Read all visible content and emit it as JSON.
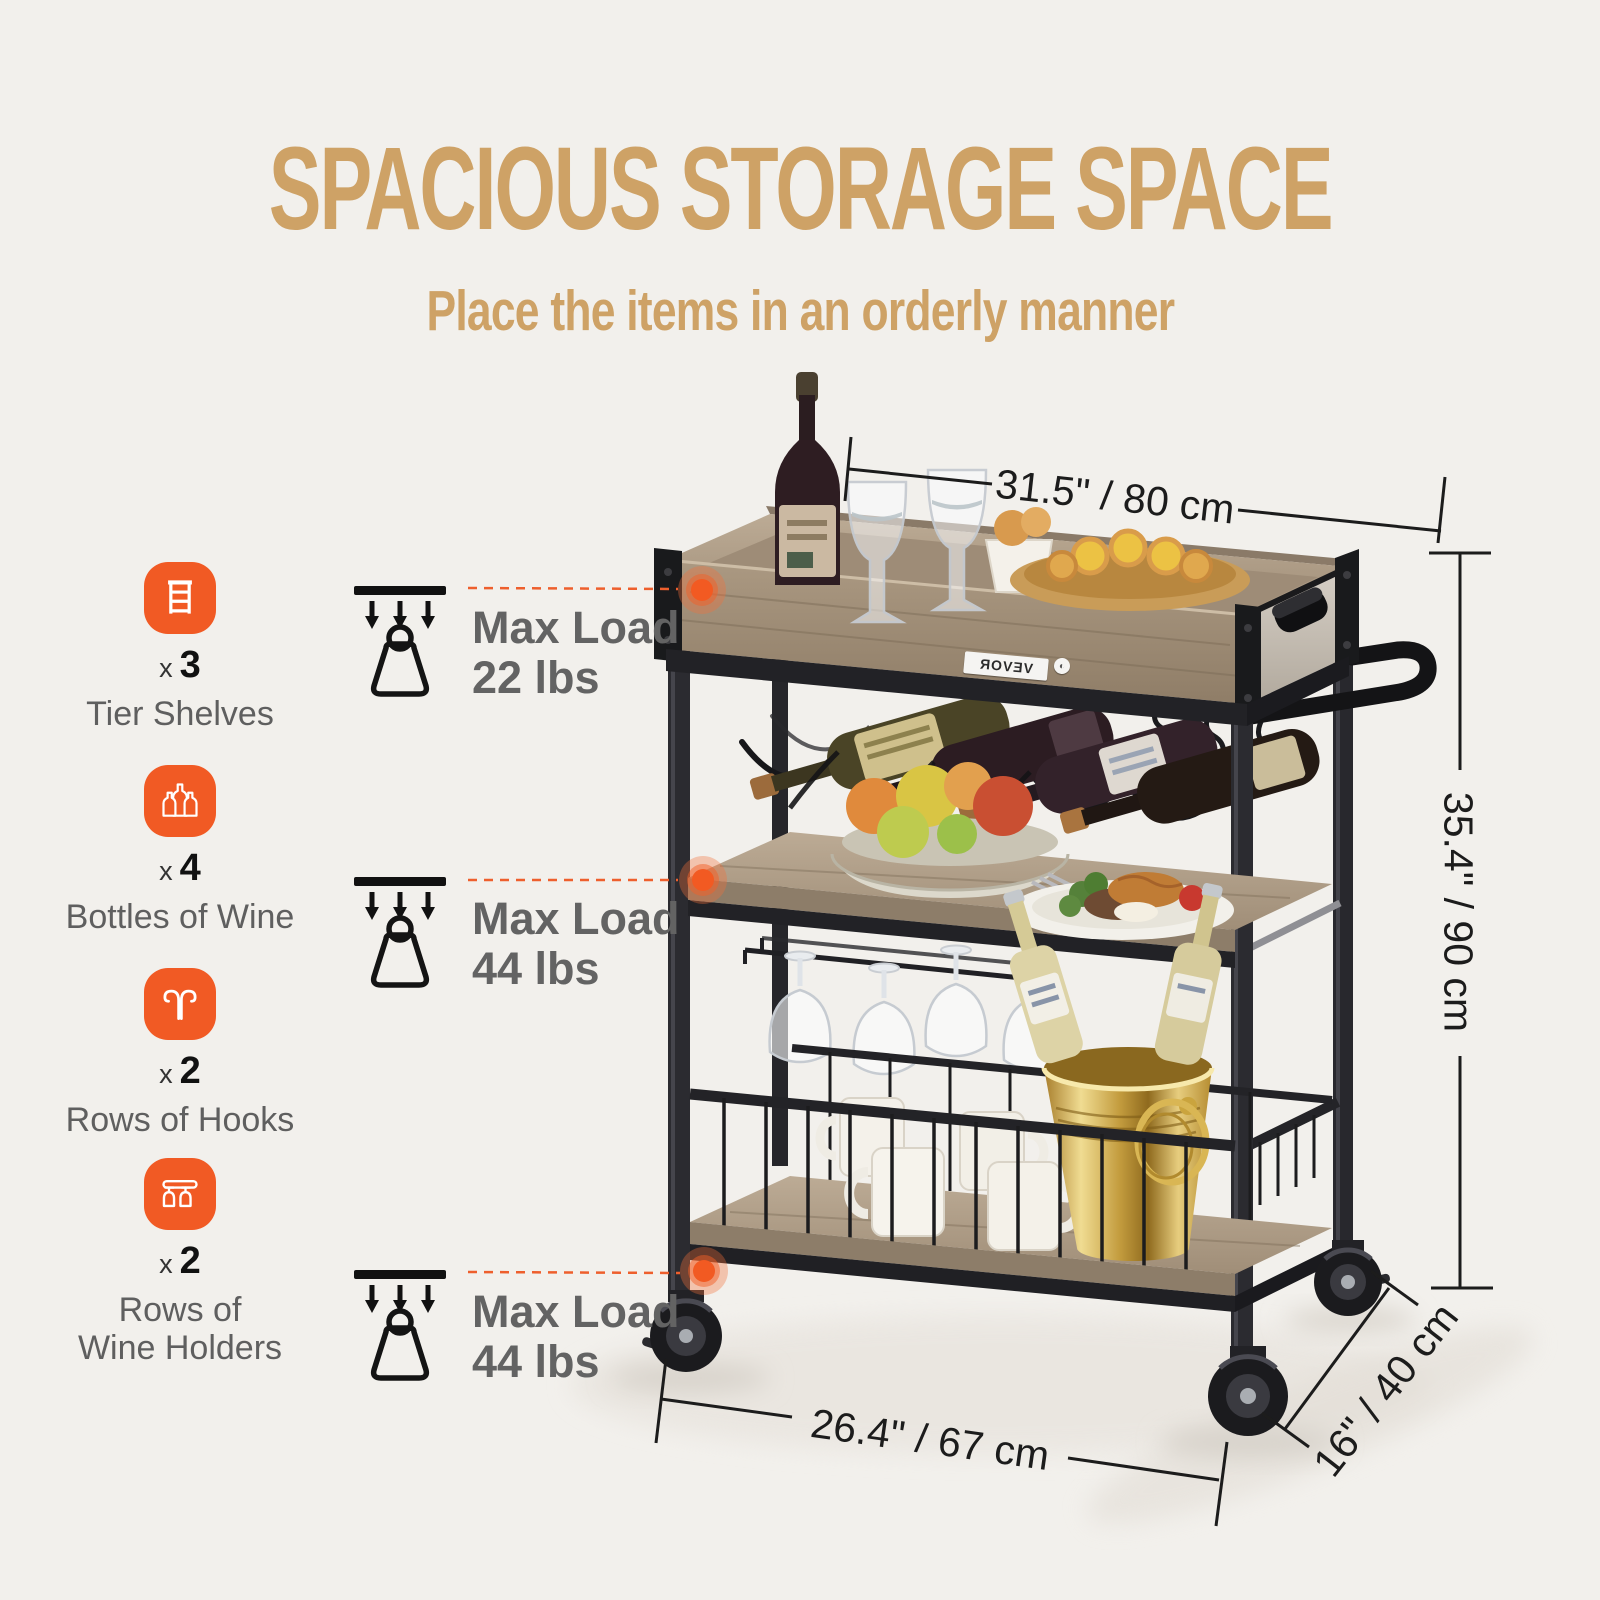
{
  "header": {
    "title": "SPACIOUS STORAGE SPACE",
    "subtitle": "Place the items in an orderly manner"
  },
  "features": [
    {
      "icon": "tier-shelves-icon",
      "times": "x",
      "count": "3",
      "label": "Tier Shelves"
    },
    {
      "icon": "wine-bottles-icon",
      "times": "x",
      "count": "4",
      "label": "Bottles of Wine"
    },
    {
      "icon": "hooks-icon",
      "times": "x",
      "count": "2",
      "label": "Rows of Hooks"
    },
    {
      "icon": "wine-glass-holders-icon",
      "times": "x",
      "count": "2",
      "label": "Rows of\nWine Holders"
    }
  ],
  "max_loads": [
    {
      "title": "Max Load",
      "value": "22 lbs"
    },
    {
      "title": "Max Load",
      "value": "44 lbs"
    },
    {
      "title": "Max Load",
      "value": "44 lbs"
    }
  ],
  "dimensions": {
    "top_width": "31.5\" / 80 cm",
    "height": "35.4\" / 90 cm",
    "bottom_width": "26.4\" / 67 cm",
    "depth": "16\" / 40 cm"
  },
  "brand": {
    "label": "VEVOR"
  },
  "colors": {
    "accent_tan": "#CEA266",
    "accent_orange": "#F15A24",
    "text_gray": "#636363",
    "line_black": "#1C1C1C",
    "background": "#F2F0EC"
  }
}
